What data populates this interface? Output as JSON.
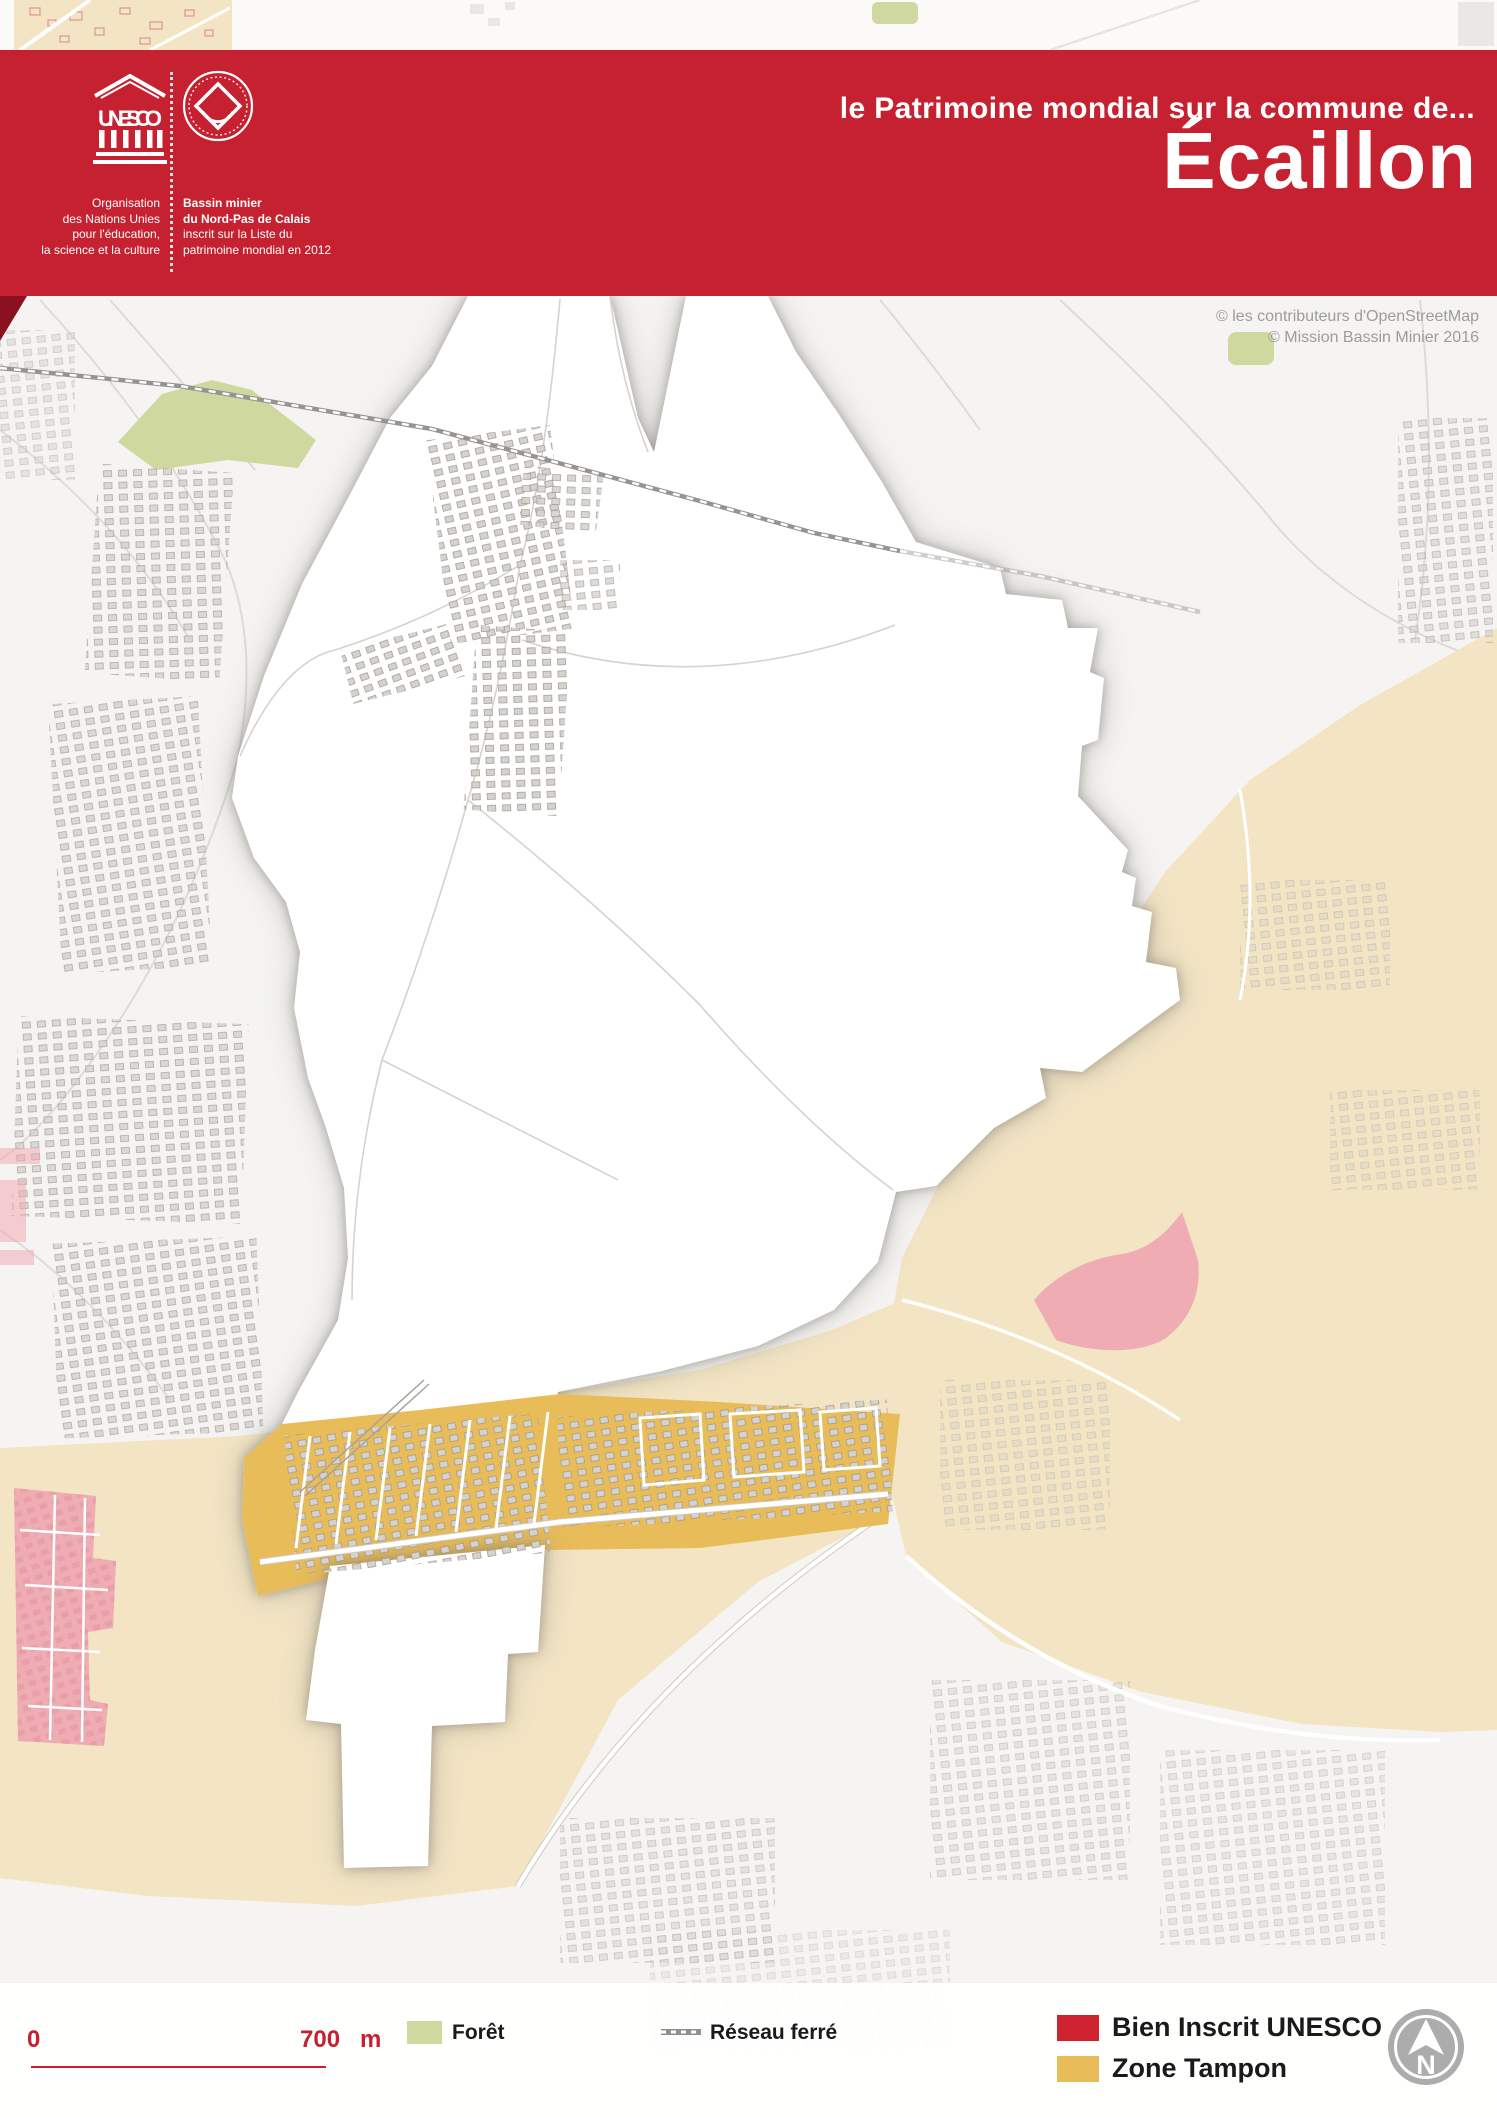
{
  "header": {
    "kicker": "le Patrimoine mondial sur la commune de...",
    "title": "Écaillon",
    "unesco_acronym": "UNESCO",
    "org_lines": [
      "Organisation",
      "des Nations Unies",
      "pour l'éducation,",
      "la science et la culture"
    ],
    "site_bold": [
      "Bassin minier",
      "du Nord-Pas de Calais"
    ],
    "site_rest": [
      "inscrit sur la Liste du",
      "patrimoine mondial en 2012"
    ]
  },
  "map": {
    "credits": [
      "© les contributeurs d'OpenStreetMap",
      "© Mission Bassin Minier 2016"
    ]
  },
  "legend": {
    "scale": {
      "zero": "0",
      "distance": "700",
      "unit": "m"
    },
    "items": [
      {
        "label": "Forêt"
      },
      {
        "label": "Réseau ferré"
      },
      {
        "label": "Bien Inscrit UNESCO"
      },
      {
        "label": "Zone Tampon"
      }
    ],
    "north_label": "N"
  },
  "colors": {
    "header_red": "#C62130",
    "fold_red": "#8A1120",
    "bien_inscrit": "#D02330",
    "bien_inscrit_muted": "#EFACB3",
    "zone_tampon": "#E8BC59",
    "zone_tampon_muted": "#F3E5C4",
    "forest": "#CFD99F",
    "rail": "#979390",
    "map_bg": "#F5F4F2",
    "commune_white": "#FFFFFF",
    "building": "#D6D2CE",
    "building_stroke": "#9A958F",
    "road": "#DEDBD6",
    "credit_gray": "#9C9C9C",
    "legend_text": "#1A1A1A",
    "scale_red": "#C62130",
    "north_gray": "#ACACAC"
  }
}
